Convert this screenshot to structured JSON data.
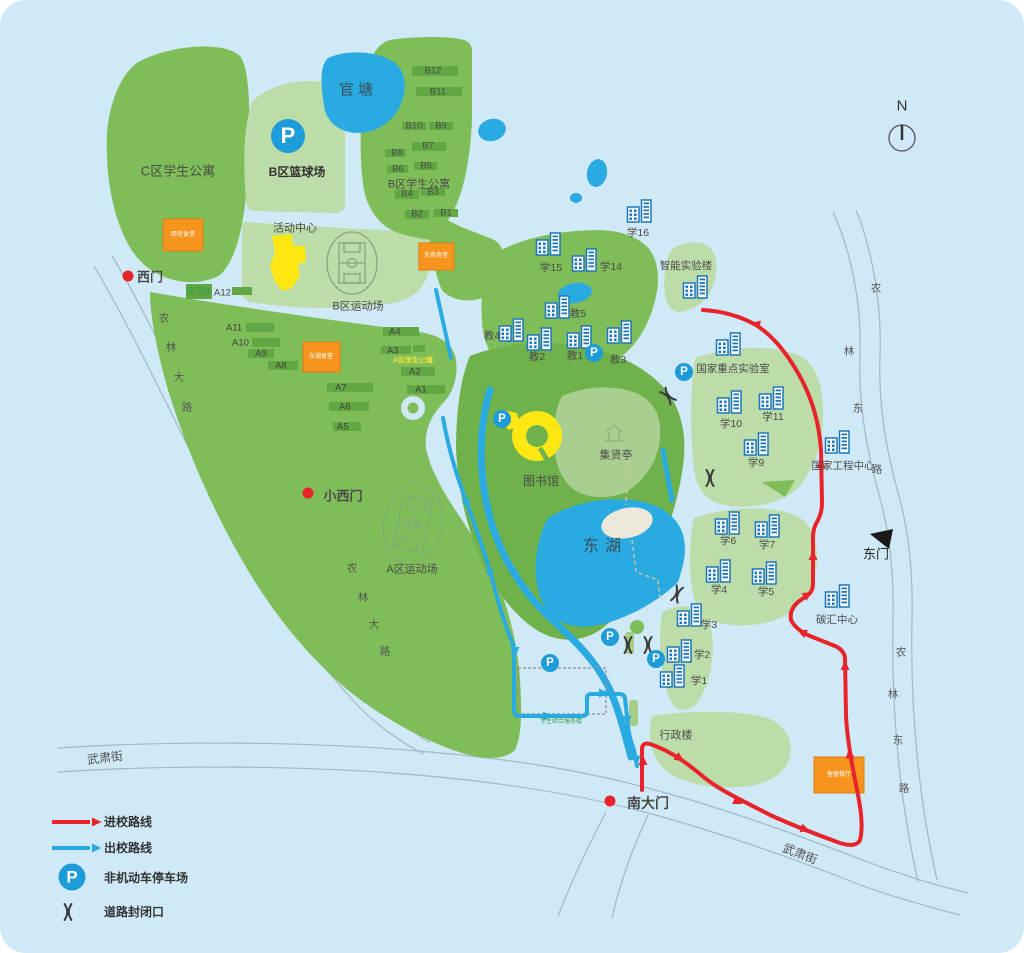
{
  "colors": {
    "background": "#CFE9F6",
    "parcel": "#7FBD58",
    "parcel_dark": "#6FB24C",
    "parcel_light": "#BCDCA9",
    "hill": "#A9CF90",
    "block": "#61A744",
    "water": "#29ABE2",
    "canteen": "#F7941E",
    "highlight": "#FFE713",
    "route_in": "#E8232A",
    "route_out": "#29ABE2",
    "icon_blue": "#1B76BC"
  },
  "compass": {
    "label": "N"
  },
  "legend": {
    "route_in": "进校路线",
    "route_out": "出校路线",
    "parking": "非机动车停车场",
    "closure": "道路封闭口"
  },
  "icons": {
    "parking_symbol": "P"
  },
  "gates": {
    "west": "西门",
    "small_west": "小西门",
    "south": "南大门",
    "east": "东门"
  },
  "water": {
    "guantang": "官塘",
    "donghu": "东湖"
  },
  "streets": {
    "wusu": "武肃街",
    "nonglin_main": [
      "农",
      "林",
      "大",
      "路"
    ],
    "nonglin_east": [
      "农",
      "林",
      "东",
      "路"
    ]
  },
  "areas": {
    "c_apartments": "C区学生公寓",
    "b_basketball": "B区篮球场",
    "b_apartments": "B区学生公寓",
    "activity_center": "活动中心",
    "b_sports": "B区运动场",
    "a_apartments": "A区学生公寓",
    "a_sports": "A区运动场",
    "library": "图书馆",
    "pavilion": "集贤亭",
    "admin": "行政楼",
    "security": "保卫处",
    "service": "学生综合服务楼"
  },
  "buildings": {
    "a_blocks": [
      "A12",
      "A11",
      "A10",
      "A9",
      "A8",
      "A7",
      "A6",
      "A5",
      "A4",
      "A3",
      "A2",
      "A1"
    ],
    "b_blocks": [
      "B12",
      "B11",
      "B10",
      "B9",
      "B8",
      "B7",
      "B6",
      "B5",
      "B4",
      "B3",
      "B2",
      "B1"
    ],
    "xue": [
      "学16",
      "学15",
      "学14",
      "学10",
      "学11",
      "学9",
      "学6",
      "学7",
      "学4",
      "学5",
      "学3",
      "学2",
      "学1"
    ],
    "jiao": [
      "教5",
      "教4",
      "教2",
      "教1",
      "教3"
    ],
    "facilities": [
      "智能实验楼",
      "国家重点实验室",
      "国家工程中心",
      "碳汇中心"
    ],
    "canteens": [
      "西径食堂",
      "东苑食堂",
      "东湖食堂",
      "留香餐厅"
    ]
  }
}
